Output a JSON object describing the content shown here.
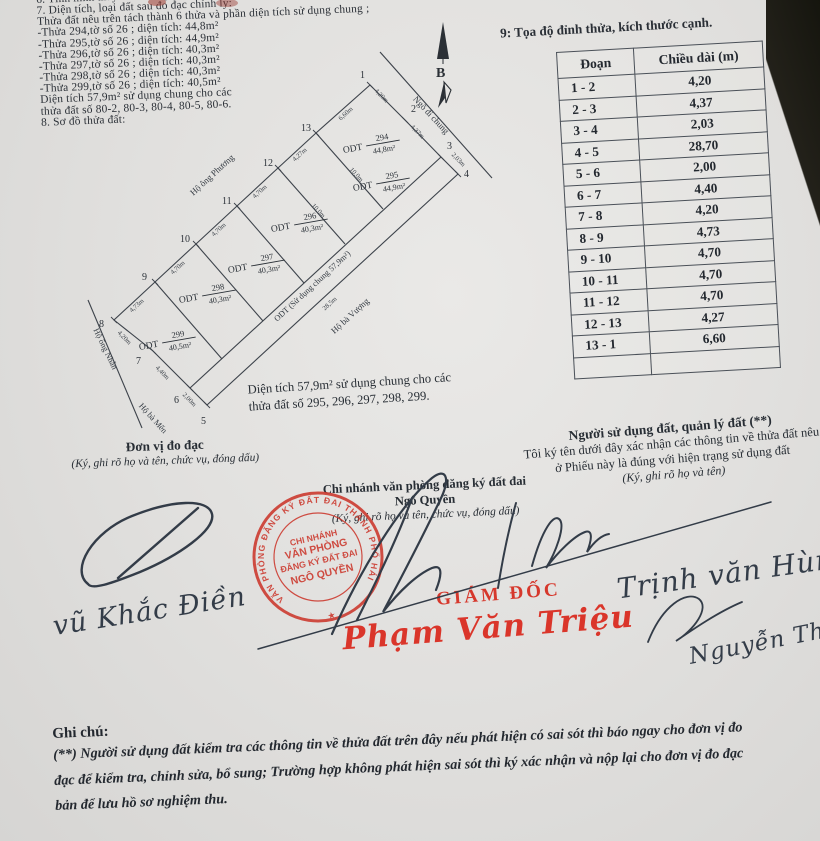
{
  "section6": {
    "line": "6. Tình hình thay đổi ranh giới thửa"
  },
  "section7": {
    "heading": "7. Diện tích, loại đất sau đo đạc chỉnh lý:",
    "intro": "Thửa đất nêu trên tách thành 6 thửa và phần diện tích sử dụng chung ;",
    "items": [
      "-Thửa 294,tờ số 26 ; diện tích: 44,8m²",
      "-Thửa 295,tờ số 26 ; diện tích: 44,9m²",
      "-Thửa 296,tờ số 26 ; diện tích: 40,3m²",
      "-Thửa 297,tờ số 26 ; diện tích: 40,3m²",
      "-Thửa 298,tờ số 26 ; diện tích: 40,3m²",
      "-Thửa 299,tờ số 26 ; diện tích: 40,5m²"
    ],
    "common1": "Diện tích 57,9m² sử dụng chung cho các",
    "common2": "thửa đất số 80-2, 80-3, 80-4, 80-5, 80-6.",
    "section8": "8. Sơ đồ thửa đất:"
  },
  "north": {
    "label": "B"
  },
  "section9": {
    "title": "9: Tọa độ đỉnh thửa, kích thước cạnh.",
    "table": {
      "col1": "Đoạn",
      "col2": "Chiều dài (m)",
      "rows": [
        {
          "seg": "1 - 2",
          "len": "4,20"
        },
        {
          "seg": "2 - 3",
          "len": "4,37"
        },
        {
          "seg": "3 - 4",
          "len": "2,03"
        },
        {
          "seg": "4 - 5",
          "len": "28,70"
        },
        {
          "seg": "5 - 6",
          "len": "2,00"
        },
        {
          "seg": "6 - 7",
          "len": "4,40"
        },
        {
          "seg": "7 - 8",
          "len": "4,20"
        },
        {
          "seg": "8 - 9",
          "len": "4,73"
        },
        {
          "seg": "9 - 10",
          "len": "4,70"
        },
        {
          "seg": "10 - 11",
          "len": "4,70"
        },
        {
          "seg": "11 - 12",
          "len": "4,70"
        },
        {
          "seg": "12 - 13",
          "len": "4,27"
        },
        {
          "seg": "13 - 1",
          "len": "6,60"
        },
        {
          "seg": "",
          "len": ""
        }
      ]
    }
  },
  "diagram": {
    "vertices": [
      "1",
      "2",
      "3",
      "4",
      "5",
      "6",
      "7",
      "8",
      "9",
      "10",
      "11",
      "12",
      "13"
    ],
    "parcels": [
      {
        "prefix": "ODT",
        "num": "294",
        "area": "44,8m²"
      },
      {
        "prefix": "ODT",
        "num": "295",
        "area": "44,9m²"
      },
      {
        "prefix": "ODT",
        "num": "296",
        "area": "40,3m²"
      },
      {
        "prefix": "ODT",
        "num": "297",
        "area": "40,3m²"
      },
      {
        "prefix": "ODT",
        "num": "298",
        "area": "40,3m²"
      },
      {
        "prefix": "ODT",
        "num": "299",
        "area": "40,5m²"
      }
    ],
    "edges": [
      "4,20m",
      "4,37m",
      "2,03m",
      "6,60m",
      "4,27m",
      "4,70m",
      "4,70m",
      "4,70m",
      "4,73m",
      "4,20m",
      "4,40m",
      "2,00m"
    ],
    "dividers": [
      "10,0m",
      "10,0m"
    ],
    "strip_len": "28,5m",
    "labels": {
      "phuong": "Hộ ông Phương",
      "alley": "Ngõ đi chung",
      "strip": "ODT (Sử dụng chung 57,9m²)",
      "vuong": "Hộ bà Vượng",
      "nhan": "Hộ ông Nhẫn",
      "men": "Hộ bà Mến"
    },
    "note1": "Diện tích 57,9m² sử dụng chung cho các",
    "note2": "thửa đất số 295, 296, 297, 298, 299."
  },
  "sign_left": {
    "title": "Đơn vị đo đạc",
    "subtitle": "(Ký, ghi rõ họ và tên, chức vụ, đóng dấu)",
    "name": "vũ Khắc Điền"
  },
  "sign_center": {
    "line1": "Chi nhánh văn phòng đăng ký đất đai",
    "line2": "Ngô Quyền",
    "subtitle": "(Ký, ghi rõ họ và tên, chức vụ, đóng dấu)",
    "role": "GIÁM ĐỐC",
    "name": "Phạm Văn Triệu"
  },
  "sign_right": {
    "title": "Người sử dụng đất, quản lý đất (**)",
    "line1": "Tôi ký tên dưới đây xác nhận các thông tin về thửa đất nêu",
    "line2": "ở Phiếu này là đúng với hiện trạng sử dụng đất",
    "subtitle": "(Ký, ghi rõ họ và tên)",
    "name1": "Trịnh văn Hùng",
    "name2": "Nguyễn Thị"
  },
  "stamp": {
    "ring": "VĂN PHÒNG ĐĂNG KÝ ĐẤT ĐAI THÀNH PHỐ HẢI PHÒNG",
    "star": "★",
    "center1": "CHI NHÁNH",
    "center2": "VĂN PHÒNG",
    "center3": "ĐĂNG KÝ ĐẤT ĐAI",
    "center4": "NGÔ QUYỀN"
  },
  "notes": {
    "heading": "Ghi chú:",
    "line1": "(**) Người sử dụng đất kiểm tra các thông tin về thửa đất trên đây nếu phát hiện có sai sót thì báo ngay cho đơn vị đo",
    "line2": "đạc để kiểm tra, chỉnh sửa, bổ sung; Trường hợp không phát hiện sai sót thì ký xác nhận và nộp lại cho đơn vị đo đạc",
    "line3": "bản để lưu hồ sơ nghiệm thu."
  },
  "colors": {
    "stamp_red": "#cc372c",
    "ink": "#333c48",
    "paper": "#e1e0de",
    "line": "#3d434b"
  }
}
